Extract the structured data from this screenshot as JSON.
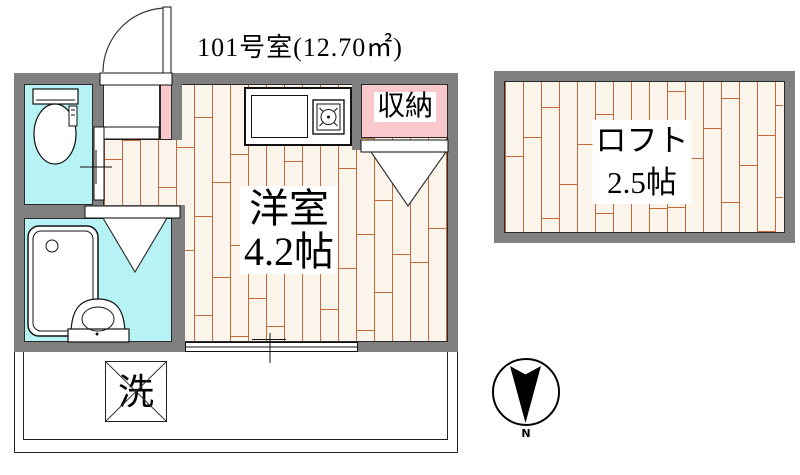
{
  "title": "101号室(12.70㎡)",
  "rooms": {
    "main": {
      "name": "洋室",
      "size": "4.2帖"
    },
    "loft": {
      "name": "ロフト",
      "size": "2.5帖"
    },
    "storage": {
      "label": "収納"
    },
    "washer": {
      "label": "洗"
    }
  },
  "compass": {
    "label": "N"
  },
  "icons": {
    "north_arrow": "north-arrow-icon",
    "toilet": "toilet-icon",
    "bathtub": "bathtub-icon",
    "washbasin": "washbasin-icon",
    "stove": "stove-burner-icon",
    "entrance_door": "door-swing-icon"
  },
  "colors": {
    "wall": "#808080",
    "water": "#b7f2f4",
    "pink": "#f9c8cc",
    "floor_bg": "#fbf4ea",
    "floor_line": "#c4693c",
    "outline": "#2a2a2a"
  }
}
